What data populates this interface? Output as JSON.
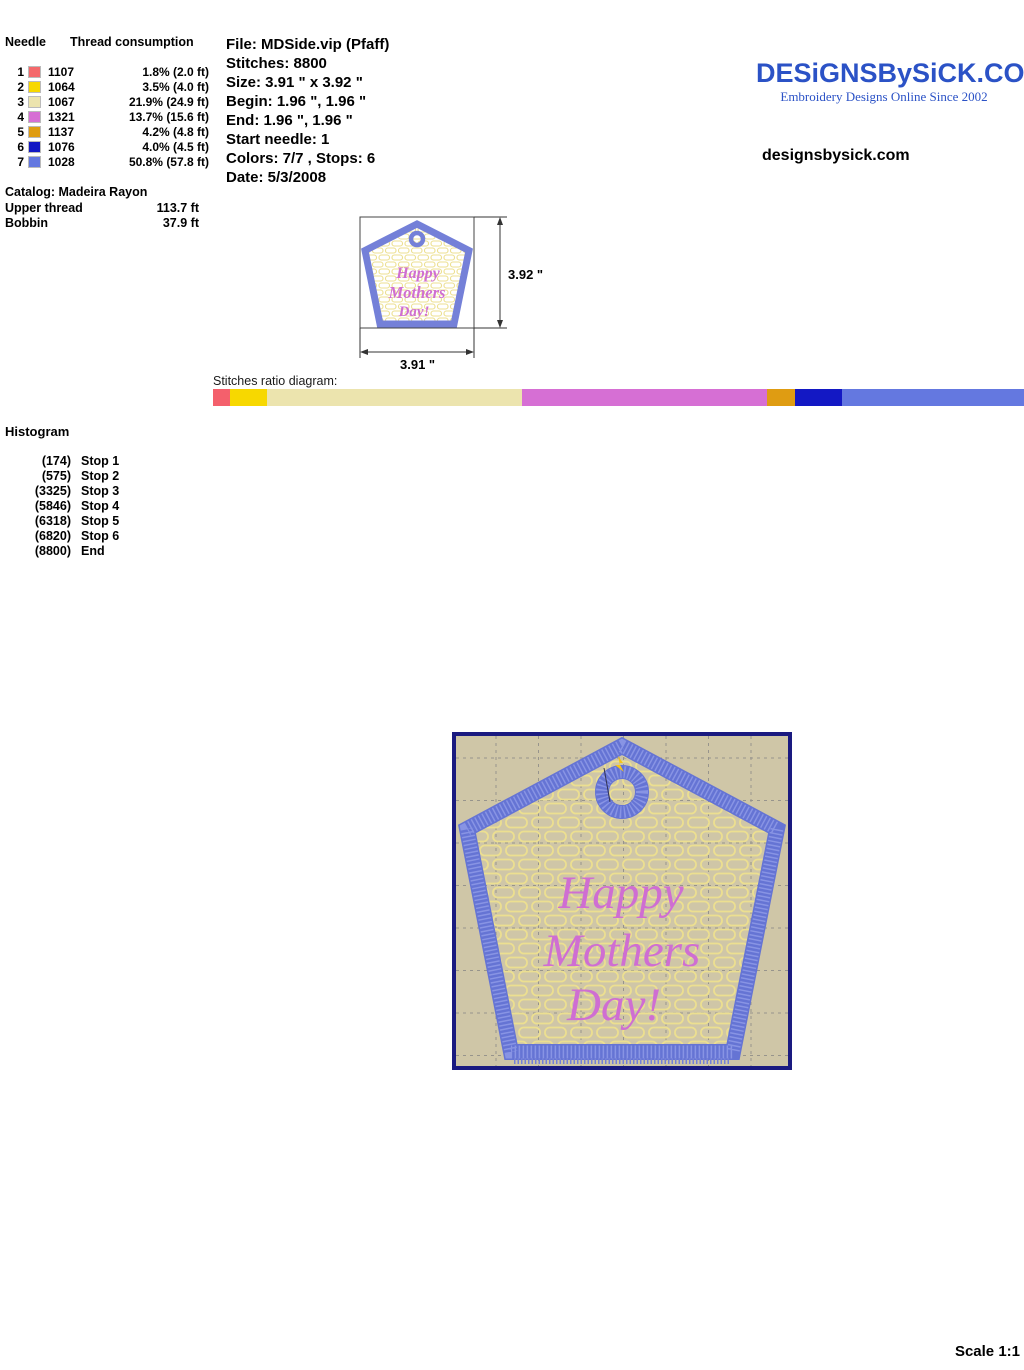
{
  "needle_table": {
    "header_needle": "Needle",
    "header_thread": "Thread consumption",
    "rows": [
      {
        "needle": "1",
        "color": "#f4696b",
        "code": "1107",
        "consumption": "1.8% (2.0 ft)"
      },
      {
        "needle": "2",
        "color": "#f7d800",
        "code": "1064",
        "consumption": "3.5% (4.0 ft)"
      },
      {
        "needle": "3",
        "color": "#ece4ae",
        "code": "1067",
        "consumption": "21.9% (24.9 ft)"
      },
      {
        "needle": "4",
        "color": "#d66fd4",
        "code": "1321",
        "consumption": "13.7% (15.6 ft)"
      },
      {
        "needle": "5",
        "color": "#df9c12",
        "code": "1137",
        "consumption": "4.2% (4.8 ft)"
      },
      {
        "needle": "6",
        "color": "#1318c4",
        "code": "1076",
        "consumption": "4.0% (4.5 ft)"
      },
      {
        "needle": "7",
        "color": "#6478e0",
        "code": "1028",
        "consumption": "50.8% (57.8 ft)"
      }
    ],
    "catalog": "Catalog: Madeira Rayon",
    "upper_thread_label": "Upper thread",
    "upper_thread_value": "113.7 ft",
    "bobbin_label": "Bobbin",
    "bobbin_value": "37.9 ft"
  },
  "file_info": {
    "lines": [
      "File: MDSide.vip  (Pfaff)",
      "Stitches: 8800",
      "Size: 3.91 \" x 3.92 \"",
      "Begin: 1.96 \", 1.96 \"",
      "End: 1.96 \", 1.96 \"",
      "Start needle: 1",
      "Colors: 7/7 , Stops: 6",
      "Date: 5/3/2008"
    ]
  },
  "branding": {
    "logo_text": "DESiGNSBySiCK.COM",
    "tagline": "Embroidery Designs Online Since 2002",
    "website": "designsbysick.com",
    "logo_color": "#2b52c6"
  },
  "design": {
    "text_lines": [
      "Happy",
      "Mothers",
      "Day!"
    ],
    "text_color": "#cf6ed2",
    "border_color": "#7480d8",
    "background_tan": "#cfc6a7",
    "pattern_yellow": "#ecdf90",
    "frame_navy": "#1a1a80"
  },
  "preview_small": {
    "height_label": "3.92 \"",
    "width_label": "3.91 \""
  },
  "ratio_diagram": {
    "label": "Stitches ratio diagram:",
    "segments": [
      {
        "color": "#f4606c",
        "width": "2.1%"
      },
      {
        "color": "#f7d800",
        "width": "4.6%"
      },
      {
        "color": "#ece4ae",
        "width": "31.4%"
      },
      {
        "color": "#d66fd4",
        "width": "30.2%"
      },
      {
        "color": "#df9c12",
        "width": "3.5%"
      },
      {
        "color": "#1318c4",
        "width": "5.8%"
      },
      {
        "color": "#6478e0",
        "width": "22.4%"
      }
    ]
  },
  "histogram": {
    "title": "Histogram",
    "entries": [
      {
        "count": "(174)",
        "label": "Stop 1"
      },
      {
        "count": "(575)",
        "label": "Stop 2"
      },
      {
        "count": "(3325)",
        "label": "Stop 3"
      },
      {
        "count": "(5846)",
        "label": "Stop 4"
      },
      {
        "count": "(6318)",
        "label": "Stop 5"
      },
      {
        "count": "(6820)",
        "label": "Stop 6"
      },
      {
        "count": "(8800)",
        "label": "End"
      }
    ]
  },
  "footer": {
    "scale_label": "Scale 1:1"
  }
}
